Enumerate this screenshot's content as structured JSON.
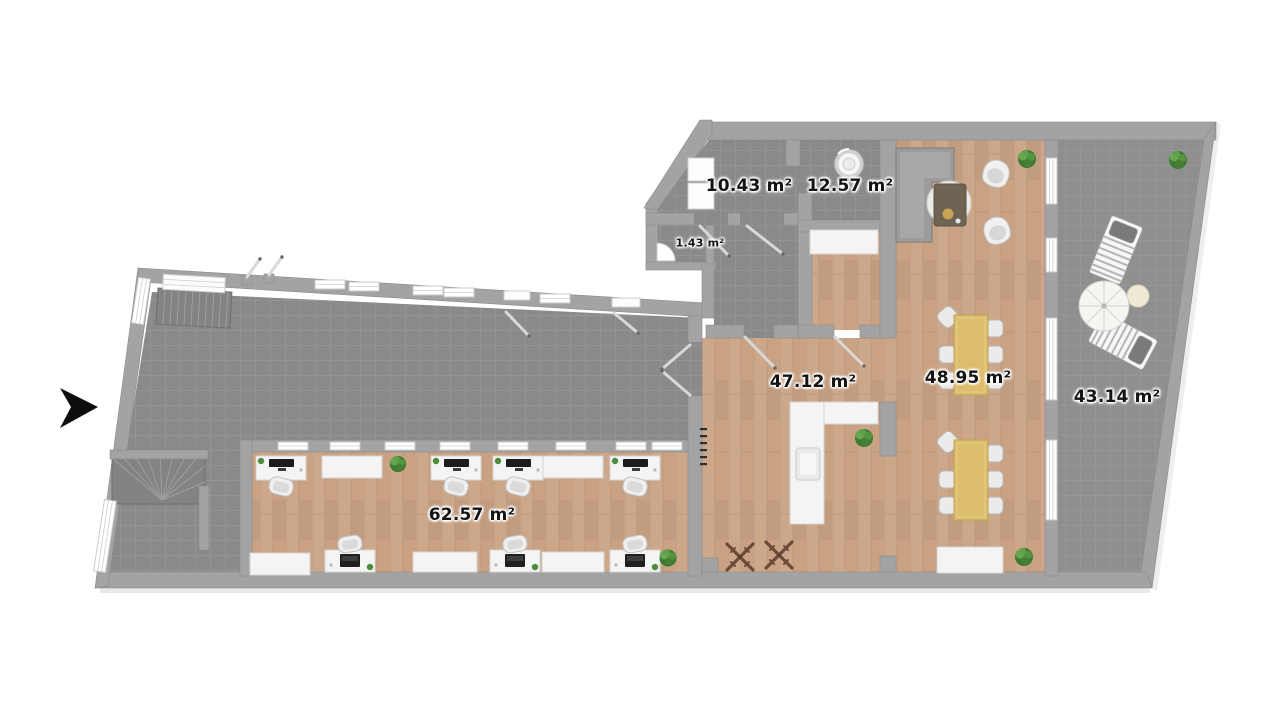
{
  "floorplan": {
    "unit": "m²",
    "rooms": [
      {
        "id": "storage-room",
        "area": "10.43",
        "label": "10.43 m²",
        "floor": "tile"
      },
      {
        "id": "utility-room",
        "area": "12.57",
        "label": "12.57 m²",
        "floor": "tile"
      },
      {
        "id": "wc",
        "area": "1.43",
        "label": "1.43 m²",
        "floor": "tile"
      },
      {
        "id": "open-space",
        "area": "47.12",
        "label": "47.12 m²",
        "floor": "wood"
      },
      {
        "id": "dining-lounge",
        "area": "48.95",
        "label": "48.95 m²",
        "floor": "wood"
      },
      {
        "id": "terrace",
        "area": "43.14",
        "label": "43.14 m²",
        "floor": "tile"
      },
      {
        "id": "office",
        "area": "62.57",
        "label": "62.57 m²",
        "floor": "wood"
      }
    ],
    "colors": {
      "wall": "#a3a3a3",
      "tile": "#8a8a8a",
      "tile-line": "#9e9e9e",
      "terrace-tile": "#8f8f8f",
      "wood": "#c9a284",
      "wood-line": "#b08a6b",
      "white-item": "#f4f4f4",
      "table-yellow": "#dcbd6b",
      "plant": "#4e8c3c",
      "label": "#141414"
    }
  }
}
